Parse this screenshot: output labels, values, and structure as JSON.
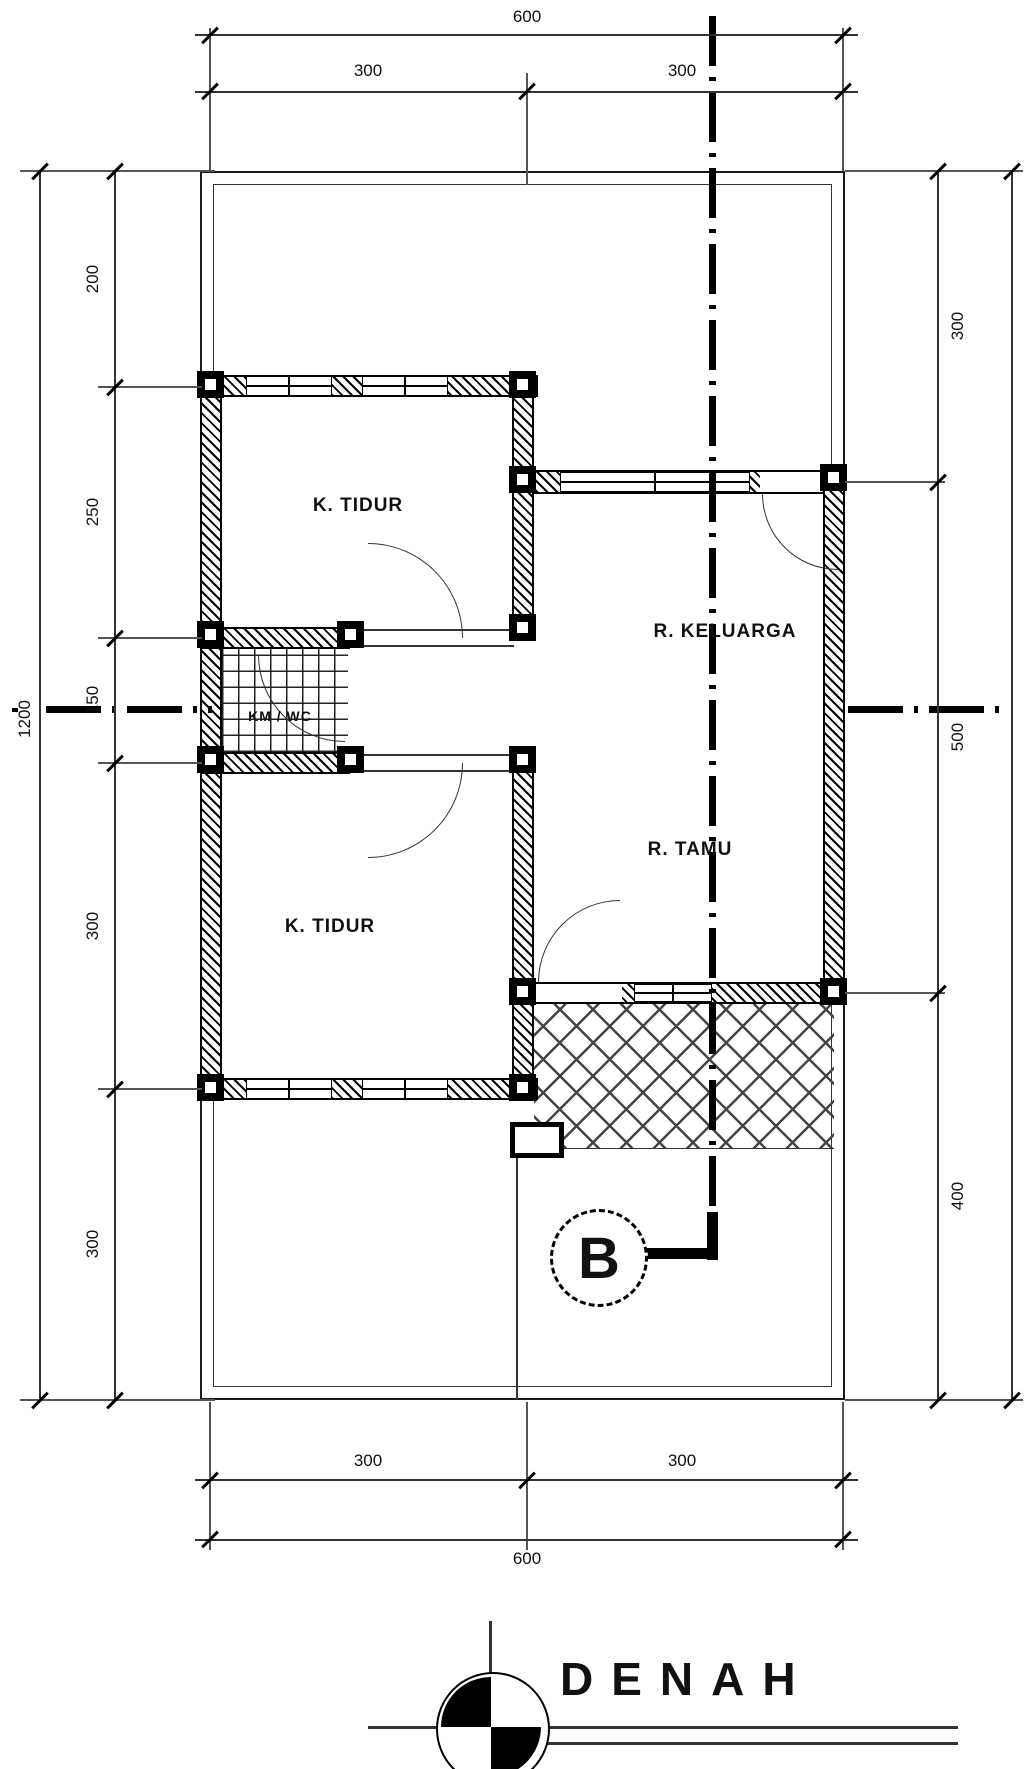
{
  "drawing": {
    "title": "DENAH",
    "section_marker": "B",
    "rooms": {
      "bedroom_top": "K. TIDUR",
      "family_room": "R. KELUARGA",
      "bathroom": "KM / WC",
      "living_room": "R. TAMU",
      "bedroom_bottom": "K. TIDUR"
    },
    "dimensions": {
      "top": {
        "overall": "600",
        "left": "300",
        "right": "300"
      },
      "bottom": {
        "overall": "600",
        "left": "300",
        "right": "300"
      },
      "left": {
        "overall": "1200",
        "s1": "200",
        "s2": "250",
        "s3": "150",
        "s4": "300",
        "s5": "300"
      },
      "right": {
        "s1": "300",
        "s2": "500",
        "s3": "400"
      }
    }
  }
}
